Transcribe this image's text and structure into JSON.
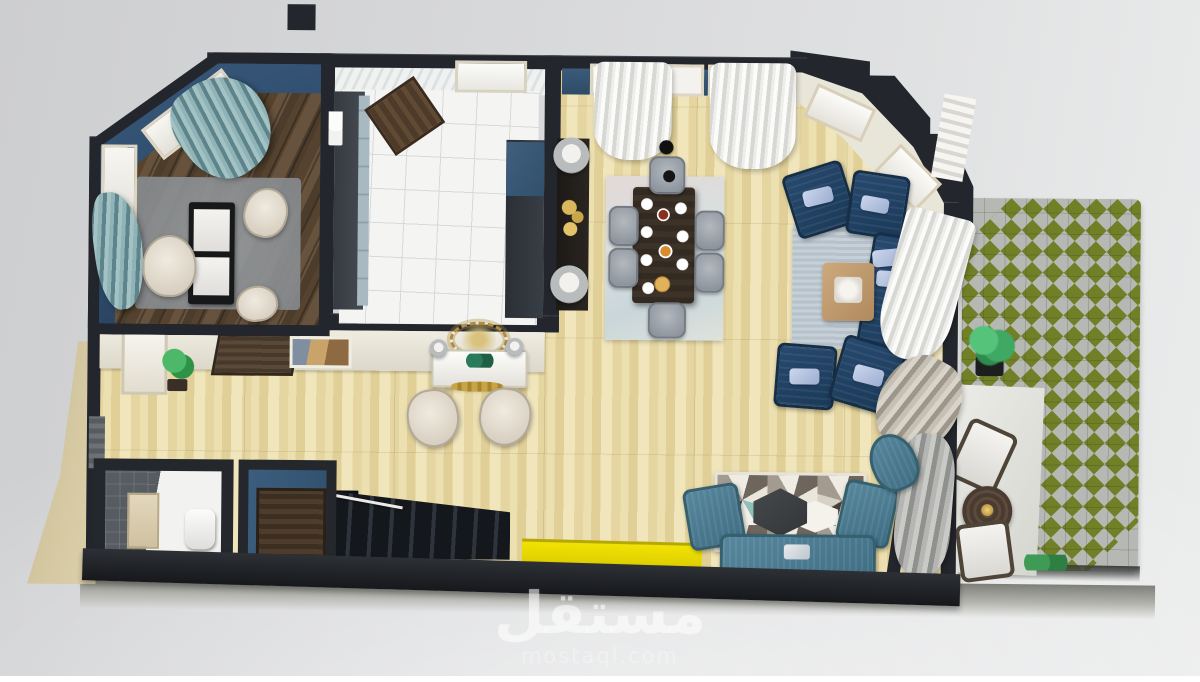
{
  "watermark": {
    "brand": "مستقل",
    "site": "mostaql.com"
  },
  "palette": {
    "wall_dark": "#23262c",
    "wall_blue": "#2f4d68",
    "wall_cream": "#e8e5d9",
    "floor_wood_light": "#e9dcab",
    "floor_wood_dark": "#5d4a38",
    "floor_tile_white": "#f4f4f3",
    "sofa_navy": "#1f4063",
    "sofa_teal": "#4e7e95",
    "chair_gray": "#9aa1a8",
    "chair_cream": "#e5ddcf",
    "accent_yellow": "#e8d802",
    "garden_grass_olive": "#6d7c20",
    "garden_paver_gray": "#b6b9b3",
    "rug_living_blue": "#c2ccd4",
    "rug_geometric_teal": "#8fc0ba",
    "curtain_teal": "#6f979e",
    "sand_strip": "#d8cba3",
    "background_gray": "#d9dadc"
  }
}
